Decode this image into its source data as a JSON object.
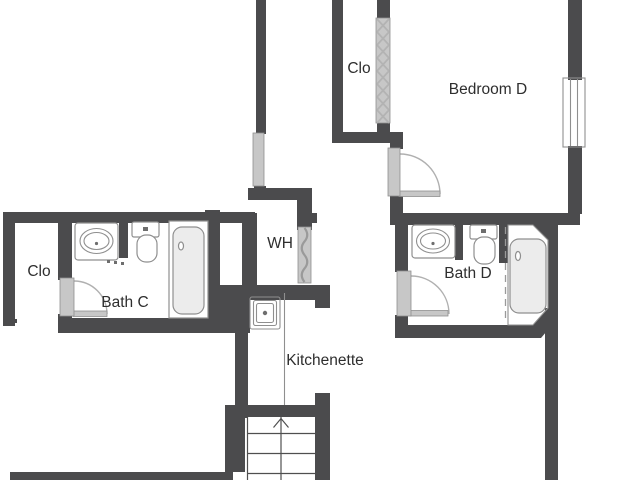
{
  "colors": {
    "wall": "#4b4b4d",
    "door": "#c7c7c7",
    "outline": "#8f8f8f",
    "swing": "#b0b0b0",
    "line": "#4f4f4f",
    "tub": "#ececec",
    "text": "#2e2e2e",
    "background": "#ffffff"
  },
  "rooms": [
    {
      "id": "closet-left",
      "label": "Clo",
      "x": 39,
      "y": 276
    },
    {
      "id": "bath-c",
      "label": "Bath C",
      "x": 125,
      "y": 307
    },
    {
      "id": "water-heater-closet",
      "label": "WH",
      "x": 280,
      "y": 248
    },
    {
      "id": "kitchenette",
      "label": "Kitchenette",
      "x": 325,
      "y": 365
    },
    {
      "id": "closet-bedroom-d",
      "label": "Clo",
      "x": 359,
      "y": 73
    },
    {
      "id": "bedroom-d",
      "label": "Bedroom D",
      "x": 488,
      "y": 94
    },
    {
      "id": "bath-d",
      "label": "Bath D",
      "x": 468,
      "y": 278
    }
  ],
  "fixtures": {
    "bath_c": [
      "vanity-sink",
      "toilet",
      "bathtub",
      "door-swing"
    ],
    "bath_d": [
      "vanity-sink",
      "toilet",
      "bathtub",
      "shower-curtain",
      "door-swing"
    ],
    "bedroom_d": [
      "window",
      "door-swing",
      "closet-sliding-door"
    ],
    "water_heater_closet": [
      "flex-door"
    ],
    "kitchenette": [
      "counter",
      "sink"
    ],
    "stairs": [
      "up-arrow",
      "treads"
    ]
  }
}
